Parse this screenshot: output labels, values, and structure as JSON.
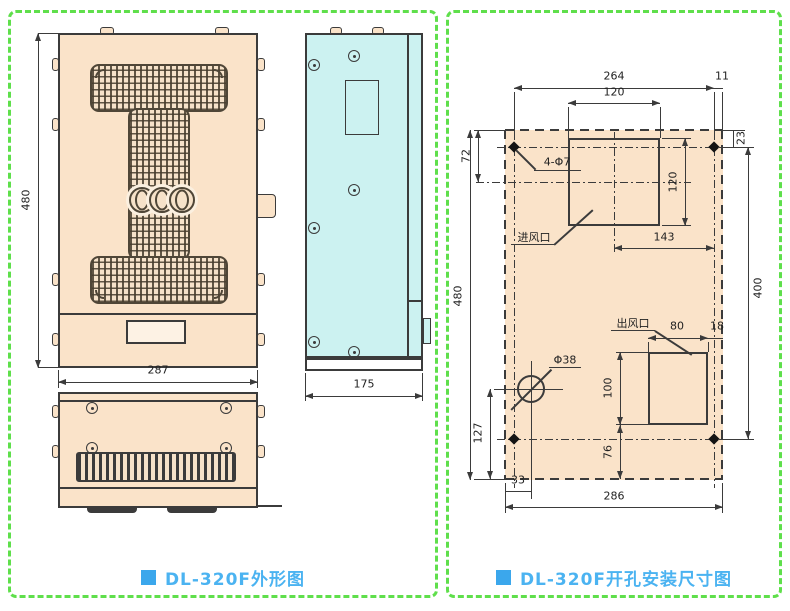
{
  "colors": {
    "panel_border": "#5fdf4b",
    "front_fill": "#fae3c9",
    "side_fill": "#ccf2f1",
    "line": "#3b3b3b",
    "caption_blue": "#4bb3f1"
  },
  "left_panel": {
    "caption": "DL-320F外形图",
    "dims": {
      "height": "480",
      "width": "287",
      "depth": "175"
    }
  },
  "right_panel": {
    "caption": "DL-320F开孔安装尺寸图",
    "dims": {
      "top_span": "264",
      "top_right_margin": "11",
      "inlet_width": "120",
      "top_to_inlet_center": "72",
      "top_to_hole_center": "23",
      "inlet_height": "120",
      "inlet_center_to_right_hole": "143",
      "hole_vertical_span": "400",
      "overall_height": "480",
      "outlet_width": "80",
      "outlet_right_margin": "18",
      "outlet_height": "100",
      "outlet_to_bottom": "76",
      "cable_hole_to_bottom": "127",
      "cable_hole_left_margin": "33",
      "overall_width": "286"
    },
    "labels": {
      "mounting_holes": "4-Φ7",
      "air_inlet": "进风口",
      "air_outlet": "出风口",
      "cable_hole_dia": "Φ38"
    }
  }
}
